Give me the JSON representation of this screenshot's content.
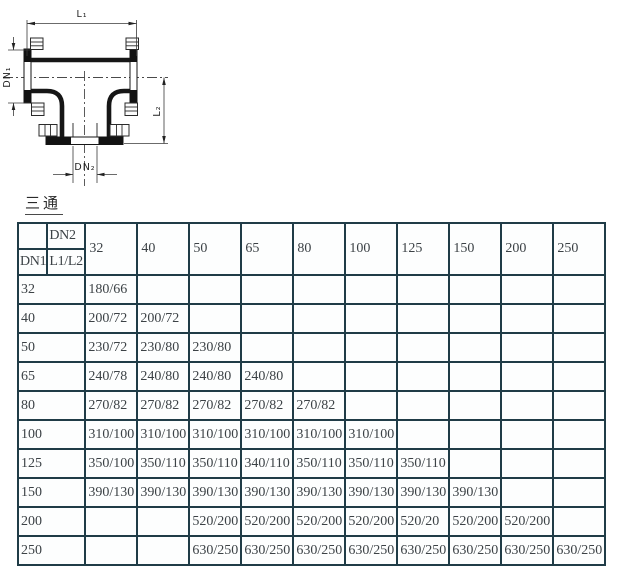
{
  "title": "三通",
  "diagram": {
    "labels": {
      "l1": "L₁",
      "dn1": "DN₁",
      "l2": "L₂",
      "dn2": "DN₂"
    }
  },
  "table": {
    "corner": {
      "dn2": "DN2",
      "dn1": "DN1",
      "l1l2": "L1/L2"
    },
    "columns": [
      "32",
      "40",
      "50",
      "65",
      "80",
      "100",
      "125",
      "150",
      "200",
      "250"
    ],
    "rows": [
      {
        "dn1": "32",
        "values": [
          "180/66",
          "",
          "",
          "",
          "",
          "",
          "",
          "",
          "",
          ""
        ]
      },
      {
        "dn1": "40",
        "values": [
          "200/72",
          "200/72",
          "",
          "",
          "",
          "",
          "",
          "",
          "",
          ""
        ]
      },
      {
        "dn1": "50",
        "values": [
          "230/72",
          "230/80",
          "230/80",
          "",
          "",
          "",
          "",
          "",
          "",
          ""
        ]
      },
      {
        "dn1": "65",
        "values": [
          "240/78",
          "240/80",
          "240/80",
          "240/80",
          "",
          "",
          "",
          "",
          "",
          ""
        ]
      },
      {
        "dn1": "80",
        "values": [
          "270/82",
          "270/82",
          "270/82",
          "270/82",
          "270/82",
          "",
          "",
          "",
          "",
          ""
        ]
      },
      {
        "dn1": "100",
        "values": [
          "310/100",
          "310/100",
          "310/100",
          "310/100",
          "310/100",
          "310/100",
          "",
          "",
          "",
          ""
        ]
      },
      {
        "dn1": "125",
        "values": [
          "350/100",
          "350/110",
          "350/110",
          "340/110",
          "350/110",
          "350/110",
          "350/110",
          "",
          "",
          ""
        ]
      },
      {
        "dn1": "150",
        "values": [
          "390/130",
          "390/130",
          "390/130",
          "390/130",
          "390/130",
          "390/130",
          "390/130",
          "390/130",
          "",
          ""
        ]
      },
      {
        "dn1": "200",
        "values": [
          "",
          "",
          "520/200",
          "520/200",
          "520/200",
          "520/200",
          "520/20",
          "520/200",
          "520/200",
          ""
        ]
      },
      {
        "dn1": "250",
        "values": [
          "",
          "",
          "630/250",
          "630/250",
          "630/250",
          "630/250",
          "630/250",
          "630/250",
          "630/250",
          "630/250"
        ]
      }
    ]
  },
  "colors": {
    "table_border": "#203c47",
    "table_text": "#3c4246",
    "drawing_line": "#161616"
  }
}
